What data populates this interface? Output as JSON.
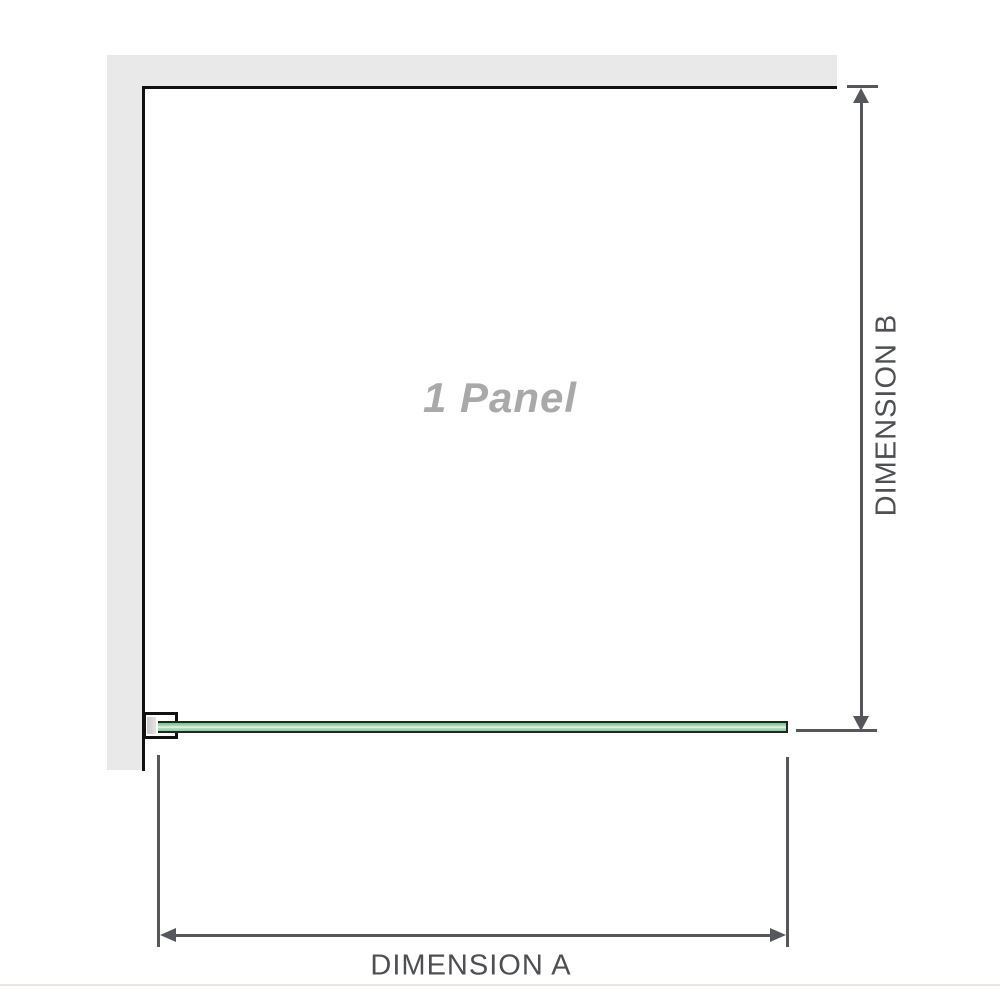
{
  "diagram": {
    "title": "Shower panel dimension diagram",
    "panel_label": "1 Panel",
    "dimension_a": {
      "label": "DIMENSION A",
      "orientation": "horizontal",
      "position": "bottom"
    },
    "dimension_b": {
      "label": "DIMENSION B",
      "orientation": "vertical",
      "position": "right",
      "reading_direction": "bottom-to-top"
    },
    "parts": {
      "wall": "l-shaped-wall",
      "clamp": "wall-mount-clamp",
      "glass": "glass-panel-top-view"
    },
    "colors": {
      "background": "#ffffff",
      "wall_fill": "#e9e9e9",
      "wall_edge_outline": "#111111",
      "dimension_line": "#55575a",
      "dimension_text": "#4d4f52",
      "panel_label_text": "#a9a9a9",
      "glass_green": "#8fcda2",
      "glass_highlight": "#e7f7eb",
      "glass_border": "#1f291f",
      "clamp_pad_fill": "#d6d6d6",
      "baseline_rule": "#e8e4de"
    }
  }
}
